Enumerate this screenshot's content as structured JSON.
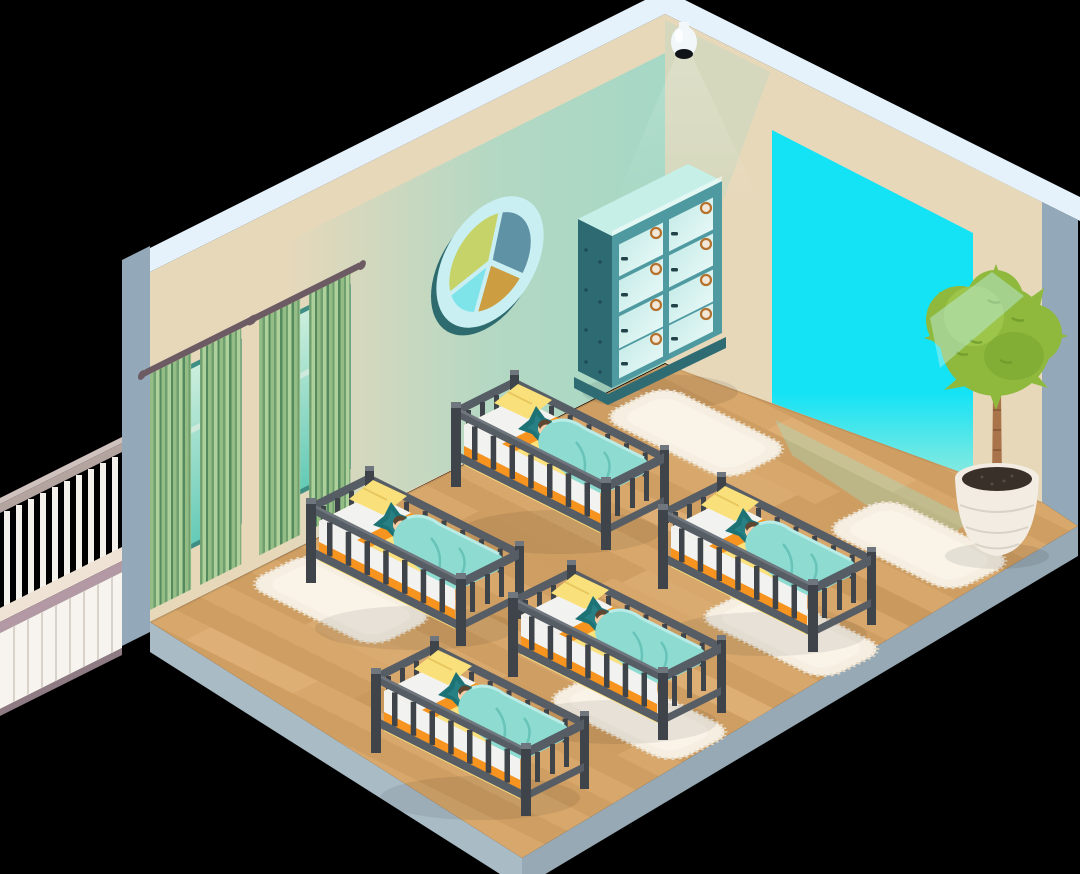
{
  "scene": {
    "style": "isometric cutaway room illustration",
    "subject": "nursery sleeping room with cribs and babies",
    "background": "#000000"
  },
  "objects": {
    "cribs": 5,
    "sleeping_babies": 5,
    "fluffy_rugs": 5,
    "curtained_windows": 2,
    "storage_locker_doors": 8,
    "security_cameras": 1,
    "potted_plants": 1,
    "round_wall_decorations": 1,
    "balcony_railings": 1,
    "bright_doorways": 1
  },
  "palette": {
    "bg": "#000000",
    "trim_white": "#e6f2fb",
    "wall_beige": "#e7d8ba",
    "wall_teal": "#a2d8c6",
    "edge_gray": "#93a9b9",
    "platform_gray": "#a9bbc5",
    "platform_dark": "#96a9b4",
    "floor_base": "#d7a76c",
    "floor_alt": "#cf9e62",
    "floor_light": "#e3b77f",
    "floor_dark": "#c6955a",
    "door_cyan": "#14e3f6",
    "door_cyan_soft": "#8feade",
    "curtain_g1": "#6f9f6e",
    "curtain_g2": "#93bd85",
    "curtain_g3": "#55895e",
    "curtain_g4": "#aed19b",
    "rod_mauve": "#6d5b64",
    "glass_mint1": "#cdeedd",
    "glass_mint2": "#63cab6",
    "glass_bar": "#cfe9dd",
    "rail_taupe": "#b3a49f",
    "rail_light": "#cfc2bc",
    "baluster_white": "#f4f0ea",
    "deck_cream": "#efe3d6",
    "fascia_mauve": "#b299a3",
    "siding_white": "#f7f3ee",
    "siding_line": "#d8d2cb",
    "pie_ring": "#c9eff3",
    "pie_rim": "#2e6b6e",
    "pie_slate": "#5f92a4",
    "pie_green": "#c6d369",
    "pie_gold": "#cc9d41",
    "pie_cyan": "#7fe3ea",
    "locker_front": "#4f9aa1",
    "locker_side": "#2d6a72",
    "locker_top": "#c6efe7",
    "locker_glass1": "#bfe9e6",
    "locker_glass2": "#eefbf9",
    "locker_base": "#2f6b73",
    "emblem_bronze": "#b5722e",
    "emblem_cream": "#f3e8d8",
    "handle_dark": "#22424a",
    "crib_dark": "#3f444a",
    "crib_mid": "#575d64",
    "crib_light": "#70767d",
    "mattress_yellow": "#fce27c",
    "mattress_side_white": "#f2f3f0",
    "bed_orange": "#f6941f",
    "pillow_yellow": "#f9e07a",
    "star_teal": "#1d7276",
    "star_teal_light": "#2e8b8e",
    "blanket_aqua": "#8edbd2",
    "blanket_shade": "#5fbdb2",
    "blanket_light": "#b9ece6",
    "baby_skin": "#f7cda6",
    "baby_hair": "#5d4632",
    "rug_fill": "#f5eee1",
    "rug_edge": "#e7dac5",
    "rug_hi": "#fbf6ec",
    "plant_green": "#8fb93c",
    "plant_dark": "#74a22e",
    "plant_light": "#a8d055",
    "trunk": "#a9744a",
    "trunk_dark": "#835636",
    "pot_white": "#f2ece2",
    "pot_shade": "#d9d2c6",
    "soil": "#39302a",
    "camera_white": "#f2f7fa",
    "camera_lens": "#101418"
  }
}
